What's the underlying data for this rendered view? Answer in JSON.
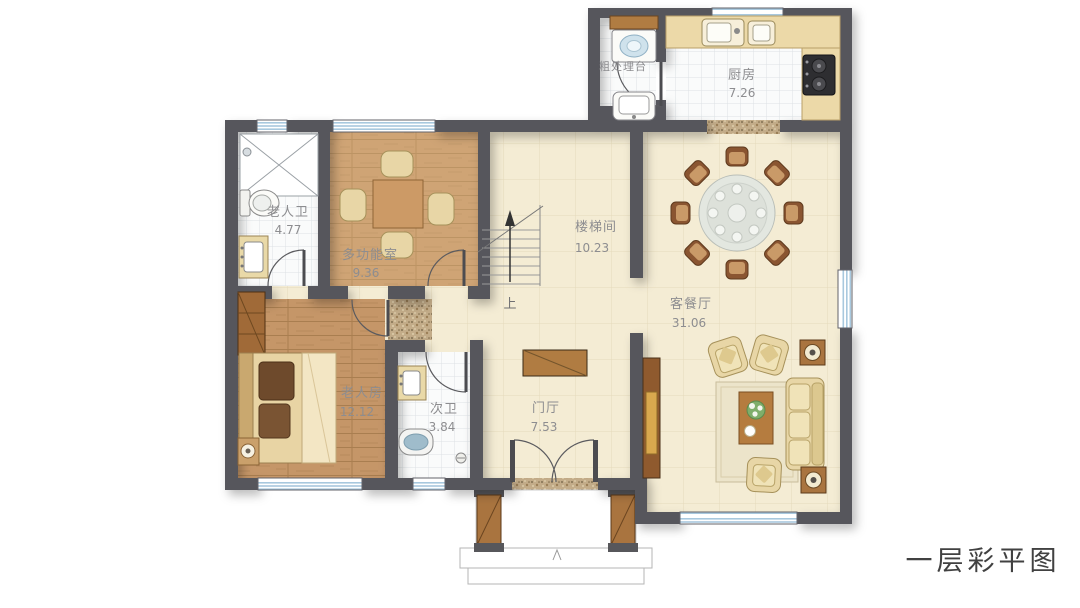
{
  "title": "一层彩平图",
  "plan": {
    "rooms": {
      "prep": {
        "name": "粗处理台"
      },
      "kitchen": {
        "name": "厨房",
        "area": "7.26"
      },
      "elder_bath": {
        "name": "老人卫",
        "area": "4.77"
      },
      "multi_room": {
        "name": "多功能室",
        "area": "9.36"
      },
      "stairwell": {
        "name": "楼梯间",
        "area": "10.23"
      },
      "living_dining": {
        "name": "客餐厅",
        "area": "31.06"
      },
      "elder_bedroom": {
        "name": "老人房",
        "area": "12.12"
      },
      "second_bath": {
        "name": "次卫",
        "area": "3.84"
      },
      "foyer": {
        "name": "门厅",
        "area": "7.53"
      }
    },
    "stair_up_label": "上",
    "colors": {
      "wall": "#57575b",
      "floor_cream": "#f4ecd4",
      "floor_wood": "#c59668",
      "floor_tile": "#fafbfb",
      "window_blue": "#a8c8de",
      "furniture_tan": "#e8d6a6",
      "furniture_brown": "#a9743f",
      "counter_beige": "#ecd9a8",
      "label_gray": "#8d8d90",
      "title_gray": "#414141"
    }
  }
}
